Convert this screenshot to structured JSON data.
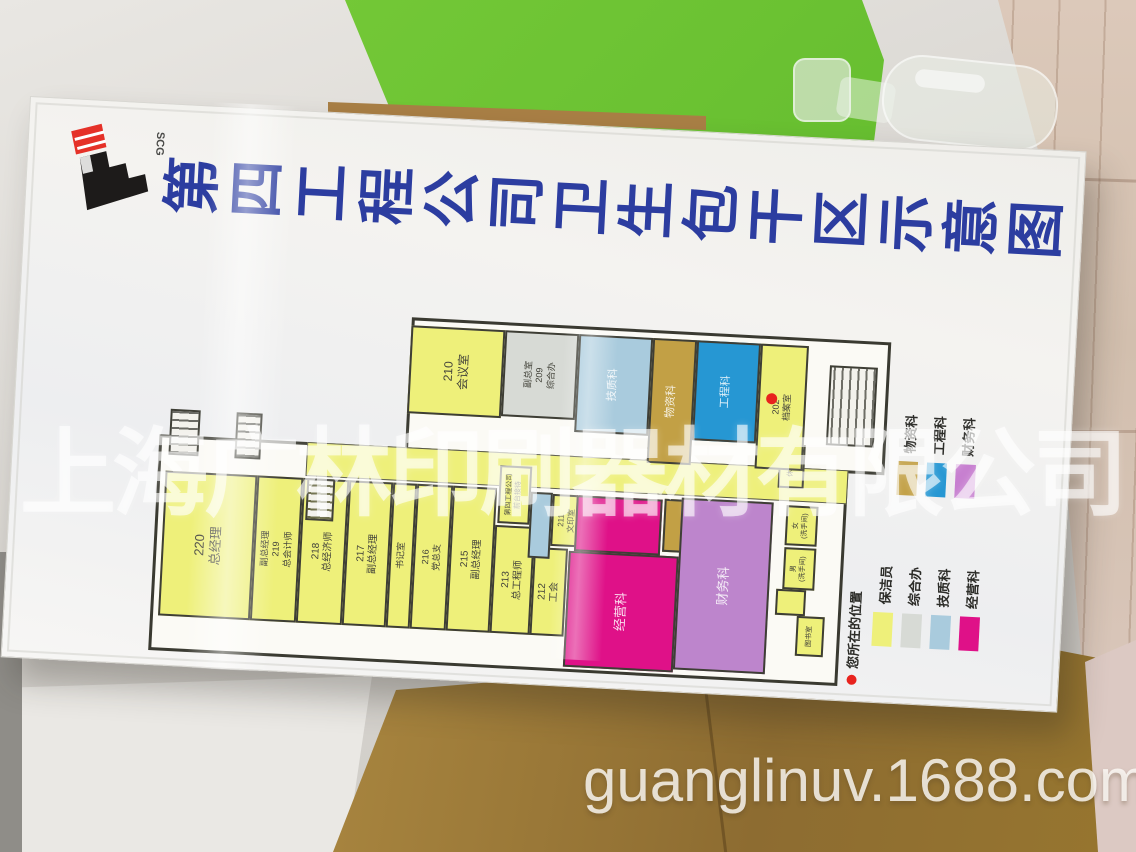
{
  "watermarks": {
    "company": "上海广林印刷器材有限公司",
    "url": "guanglinuv.1688.com"
  },
  "sign": {
    "title": "第四工程公司卫生包干区示意图",
    "logo": {
      "text": "SCG"
    },
    "location_legend": "您所在的位置",
    "legend_groups": [
      {
        "name": "departments-upper",
        "items": [
          {
            "label": "物资科",
            "color": "#c2a045"
          },
          {
            "label": "工程科",
            "color": "#2697d3"
          },
          {
            "label": "财务科",
            "color": "#c77fd0"
          }
        ]
      },
      {
        "name": "departments-lower",
        "items": [
          {
            "label": "保洁员",
            "color": "#eef07a"
          },
          {
            "label": "综合办",
            "color": "#d7dad5"
          },
          {
            "label": "技质科",
            "color": "#a9cbdd"
          },
          {
            "label": "经营科",
            "color": "#df1188"
          }
        ]
      }
    ],
    "plan": {
      "palette": {
        "yellow": "#eef07a",
        "gray": "#d7dad5",
        "lblue": "#a9cbdd",
        "tan": "#c2a045",
        "blue": "#2697d3",
        "magenta": "#df1188",
        "orchid": "#bd85cc"
      },
      "rooms": [
        {
          "label": "220\n总经理",
          "x": 35,
          "y": 8,
          "w": 145,
          "h": 92,
          "c": "yellow",
          "fs": 13
        },
        {
          "label": "副总经理\n219\n总会计师",
          "x": 35,
          "y": 100,
          "w": 145,
          "h": 46,
          "c": "yellow",
          "fs": 9
        },
        {
          "label": "218\n总经济师",
          "x": 35,
          "y": 146,
          "w": 145,
          "h": 46,
          "c": "yellow",
          "fs": 10
        },
        {
          "label": "217\n副总经理",
          "x": 35,
          "y": 192,
          "w": 145,
          "h": 44,
          "c": "yellow",
          "fs": 10
        },
        {
          "label": "书记室",
          "x": 35,
          "y": 236,
          "w": 145,
          "h": 24,
          "c": "yellow",
          "fs": 9
        },
        {
          "label": "216\n党总支",
          "x": 35,
          "y": 260,
          "w": 145,
          "h": 36,
          "c": "yellow",
          "fs": 9
        },
        {
          "label": "215\n副总经理",
          "x": 35,
          "y": 296,
          "w": 145,
          "h": 44,
          "c": "yellow",
          "fs": 10
        },
        {
          "label": "213\n总工程师",
          "x": 35,
          "y": 340,
          "w": 108,
          "h": 40,
          "c": "yellow",
          "fs": 10
        },
        {
          "label": "212\n工会",
          "x": 35,
          "y": 380,
          "w": 88,
          "h": 34,
          "c": "yellow",
          "fs": 10
        },
        {
          "label": "211\n文印室",
          "x": 125,
          "y": 396,
          "w": 52,
          "h": 30,
          "c": "yellow",
          "fs": 8
        },
        {
          "label": "第四工程公司\n前台接待",
          "x": 145,
          "y": 342,
          "w": 58,
          "h": 32,
          "c": "yellow",
          "fs": 7
        },
        {
          "label": "",
          "x": 112,
          "y": 374,
          "w": 66,
          "h": 22,
          "c": "lblue"
        },
        {
          "label": "经营科",
          "x": 5,
          "y": 415,
          "w": 116,
          "h": 110,
          "c": "magenta",
          "fs": 13,
          "lt": true
        },
        {
          "label": "",
          "x": 121,
          "y": 420,
          "w": 56,
          "h": 86,
          "c": "magenta"
        },
        {
          "label": "",
          "x": 125,
          "y": 508,
          "w": 53,
          "h": 34,
          "c": "tan"
        },
        {
          "label": "财务科",
          "x": 8,
          "y": 525,
          "w": 172,
          "h": 92,
          "c": "orchid",
          "fs": 13,
          "lt": true
        },
        {
          "label": "休息室",
          "x": 195,
          "y": 620,
          "w": 44,
          "h": 26,
          "c": "yellow",
          "fs": 7
        },
        {
          "label": "",
          "x": 68,
          "y": 624,
          "w": 26,
          "h": 30,
          "c": "yellow"
        },
        {
          "label": "女\n(洗手间)",
          "x": 138,
          "y": 630,
          "w": 40,
          "h": 32,
          "c": "yellow",
          "fs": 7
        },
        {
          "label": "男\n(洗手间)",
          "x": 94,
          "y": 630,
          "w": 42,
          "h": 32,
          "c": "yellow",
          "fs": 7
        },
        {
          "label": "图书室",
          "x": 28,
          "y": 646,
          "w": 40,
          "h": 28,
          "c": "yellow",
          "fs": 7
        },
        {
          "label": "210\n会议室",
          "x": 250,
          "y": 246,
          "w": 88,
          "h": 94,
          "c": "yellow",
          "fs": 12
        },
        {
          "label": "副总室\n209\n综合办",
          "x": 252,
          "y": 340,
          "w": 86,
          "h": 74,
          "c": "gray",
          "fs": 9
        },
        {
          "label": "技质科",
          "x": 240,
          "y": 414,
          "w": 98,
          "h": 74,
          "c": "lblue",
          "fs": 11,
          "lt": true
        },
        {
          "label": "物资科",
          "x": 213,
          "y": 488,
          "w": 125,
          "h": 44,
          "c": "tan",
          "fs": 11,
          "lt": true
        },
        {
          "label": "工程科",
          "x": 238,
          "y": 532,
          "w": 100,
          "h": 64,
          "c": "blue",
          "fs": 11,
          "lt": true
        },
        {
          "label": "202\n档案室",
          "x": 213,
          "y": 596,
          "w": 125,
          "h": 48,
          "c": "yellow",
          "fs": 9
        }
      ],
      "stairs": [
        {
          "x": 196,
          "y": 10,
          "w": 46,
          "h": 30,
          "dir": "h"
        },
        {
          "x": 196,
          "y": 76,
          "w": 46,
          "h": 26,
          "dir": "h"
        },
        {
          "x": 138,
          "y": 150,
          "w": 42,
          "h": 28,
          "dir": "h"
        },
        {
          "x": 240,
          "y": 666,
          "w": 80,
          "h": 48,
          "dir": "v"
        }
      ]
    }
  }
}
